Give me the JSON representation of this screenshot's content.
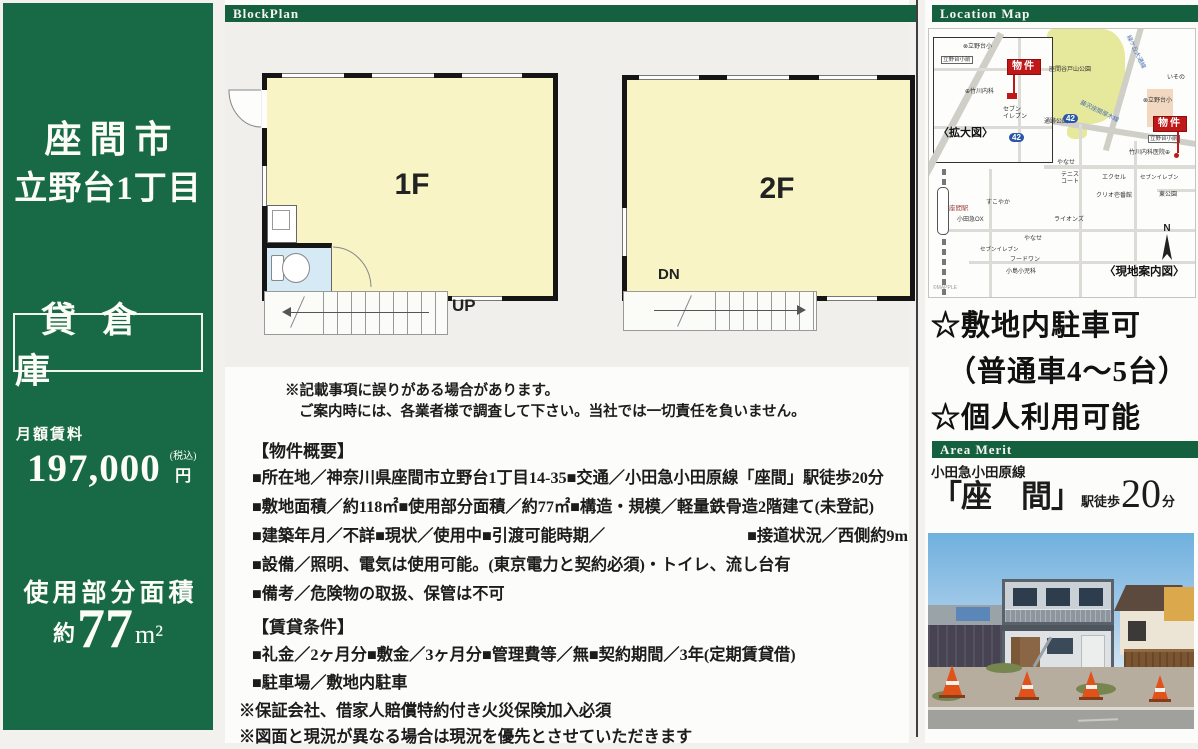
{
  "sidebar": {
    "city": "座間市",
    "district": "立野台1丁目",
    "property_type": "貸倉庫",
    "rent_label": "月額賃料",
    "rent_value": "197,000",
    "rent_tax_note": "(税込)",
    "rent_unit": "円",
    "area_label": "使用部分面積",
    "area_prefix": "約",
    "area_value": "77",
    "area_unit": "m²"
  },
  "blockplan": {
    "header": "BlockPlan",
    "floor1_label": "1F",
    "floor2_label": "2F",
    "up_label": "UP",
    "dn_label": "DN",
    "disclaimer_line1": "※記載事項に誤りがある場合があります。",
    "disclaimer_line2": "ご案内時には、各業者様で調査して下さい。当社では一切責任を負いません。"
  },
  "summary": {
    "title": "【物件概要】",
    "lines": [
      {
        "text": "■所在地／神奈川県座間市立野台1丁目14-35■交通／小田急小田原線「座間」駅徒歩20分"
      },
      {
        "text": "■敷地面積／約118㎡■使用部分面積／約77㎡■構造・規模／軽量鉄骨造2階建て(未登記)"
      },
      {
        "text": "■建築年月／不詳■現状／使用中■引渡可能時期／",
        "right": "■接道状況／西側約9m"
      },
      {
        "text": "■設備／照明、電気は使用可能。(東京電力と契約必須)・トイレ、流し台有"
      },
      {
        "text": "■備考／危険物の取扱、保管は不可"
      }
    ]
  },
  "rental": {
    "title": "【賃貸条件】",
    "lines": [
      {
        "text": "■礼金／2ヶ月分■敷金／3ヶ月分■管理費等／無■契約期間／3年(定期賃貸借)",
        "cls": "item"
      },
      {
        "text": "■駐車場／敷地内駐車",
        "cls": "item"
      },
      {
        "text": "※保証会社、借家人賠償特約付き火災保険加入必須",
        "cls": "note"
      },
      {
        "text": "※図面と現況が異なる場合は現況を優先とさせていただきます",
        "cls": "note"
      }
    ]
  },
  "location_map": {
    "header": "Location Map",
    "labels": [
      {
        "t": "⊗立野台小",
        "x": 34,
        "y": 15,
        "fs": 6
      },
      {
        "t": "立野台小前",
        "x": 12,
        "y": 27,
        "fs": 5.5,
        "box": true
      },
      {
        "t": "物件",
        "x": 78,
        "y": 30,
        "fs": 10,
        "flag": true
      },
      {
        "t": "⊕竹川内科",
        "x": 36,
        "y": 60,
        "fs": 6
      },
      {
        "t": "セブン\nイレブン",
        "x": 74,
        "y": 78,
        "fs": 6
      },
      {
        "t": "〈拡大図〉",
        "x": 9,
        "y": 98,
        "fs": 11,
        "bold": true
      },
      {
        "t": "42",
        "x": 80,
        "y": 104,
        "fs": 8,
        "badge": true
      },
      {
        "t": "座間谷戸山公園",
        "x": 120,
        "y": 38,
        "fs": 6
      },
      {
        "t": "緑ケ丘大通線",
        "x": 188,
        "y": 20,
        "fs": 6,
        "rot": 64,
        "c": "#4a6fae"
      },
      {
        "t": "いその",
        "x": 238,
        "y": 46,
        "fs": 6
      },
      {
        "t": "42",
        "x": 134,
        "y": 85,
        "fs": 8,
        "badge": true
      },
      {
        "t": "藤沢座間厚木線",
        "x": 149,
        "y": 80,
        "fs": 6,
        "rot": 26,
        "c": "#4a6fae"
      },
      {
        "t": "⊗立野台小",
        "x": 214,
        "y": 69,
        "fs": 6
      },
      {
        "t": "物件",
        "x": 224,
        "y": 87,
        "fs": 10,
        "flag": true
      },
      {
        "t": "立野台小前",
        "x": 219,
        "y": 106,
        "fs": 5.5,
        "box": true
      },
      {
        "t": "竹川内科医院⊕",
        "x": 200,
        "y": 121,
        "fs": 6
      },
      {
        "t": "エクセル",
        "x": 173,
        "y": 146,
        "fs": 6
      },
      {
        "t": "セブンイレブン",
        "x": 211,
        "y": 146,
        "fs": 5.5
      },
      {
        "t": "クリオ壱番館",
        "x": 167,
        "y": 164,
        "fs": 6
      },
      {
        "t": "東公園",
        "x": 230,
        "y": 163,
        "fs": 6
      },
      {
        "t": "通跡公園",
        "x": 115,
        "y": 90,
        "fs": 6
      },
      {
        "t": "やなせ",
        "x": 128,
        "y": 131,
        "fs": 6
      },
      {
        "t": "テニス\nコート",
        "x": 132,
        "y": 143,
        "fs": 6
      },
      {
        "t": "すこやか",
        "x": 57,
        "y": 171,
        "fs": 6
      },
      {
        "t": "座間駅",
        "x": 20,
        "y": 176,
        "fs": 6.5,
        "c": "#a04848"
      },
      {
        "t": "小田急OX",
        "x": 28,
        "y": 188,
        "fs": 6
      },
      {
        "t": "ライオンズ",
        "x": 125,
        "y": 188,
        "fs": 6
      },
      {
        "t": "やなせ",
        "x": 95,
        "y": 207,
        "fs": 6
      },
      {
        "t": "セブンイレブン",
        "x": 51,
        "y": 218,
        "fs": 5.5
      },
      {
        "t": "フードワン",
        "x": 81,
        "y": 228,
        "fs": 6
      },
      {
        "t": "小島小児科",
        "x": 77,
        "y": 240,
        "fs": 6
      },
      {
        "t": "〈現地案内図〉",
        "x": 175,
        "y": 237,
        "fs": 11.5,
        "bold": true
      },
      {
        "t": "©MAPPLE",
        "x": 4,
        "y": 257,
        "fs": 5,
        "c": "#999999"
      }
    ],
    "compass": "N"
  },
  "highlights": {
    "line1": "☆敷地内駐車可",
    "line2": "（普通車4～5台）",
    "line3": "☆個人利用可能"
  },
  "area_merit": {
    "header": "Area Merit",
    "line_name": "小田急小田原線",
    "station": "「座　間」",
    "station_suffix": "駅徒歩",
    "minutes": "20",
    "minutes_unit": "分"
  }
}
